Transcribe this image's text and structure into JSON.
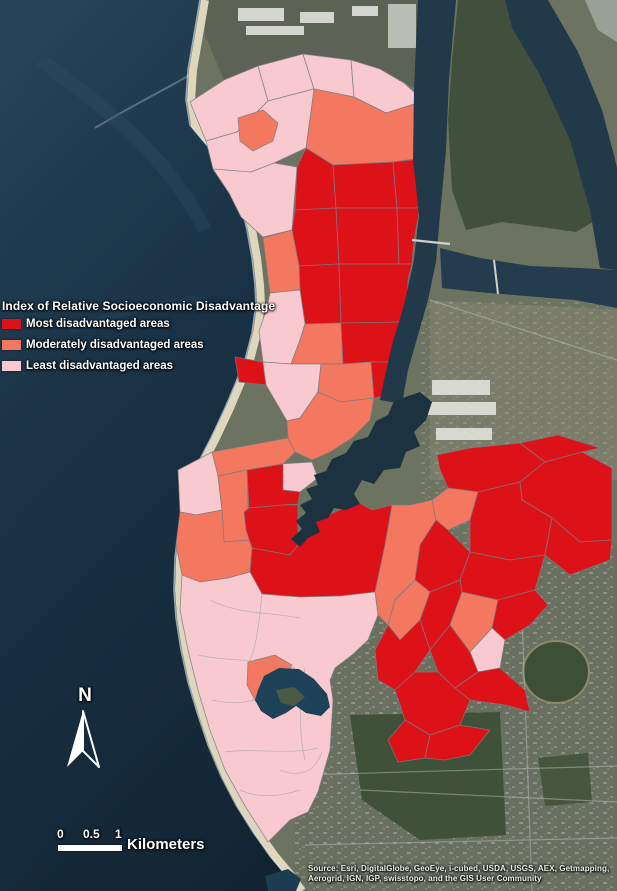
{
  "map": {
    "legend": {
      "title": "Index of Relative Socioeconomic Disadvantage",
      "items": [
        {
          "key": "most",
          "label": "Most disadvantaged areas"
        },
        {
          "key": "moderate",
          "label": "Moderately disadvantaged areas"
        },
        {
          "key": "least",
          "label": "Least disadvantaged areas"
        }
      ]
    },
    "class_colors": {
      "most": "#dc1218",
      "moderate": "#f4775f",
      "least": "#f9c9d0"
    },
    "region_stroke": "#787d83",
    "north_arrow": {
      "label": "N"
    },
    "scale_bar": {
      "tick_labels": [
        "0",
        "0.5",
        "1"
      ],
      "unit_label": "Kilometers"
    },
    "attribution": {
      "line1": "Source: Esri, DigitalGlobe, GeoEye, i-cubed, USDA, USGS, AEX, Getmapping,",
      "line2": "Aerogrid, IGN, IGP, swisstopo, and the GIS User Community"
    },
    "regions": [
      {
        "class": "least",
        "points": "190,102 224,80 258,66 268,101 237,132 206,141"
      },
      {
        "class": "least",
        "points": "258,66 303,54 314,89 268,101"
      },
      {
        "class": "least",
        "points": "303,54 351,60 354,97 314,89"
      },
      {
        "class": "least",
        "points": "351,60 380,69 404,83 424,101 386,113 354,97"
      },
      {
        "class": "moderate",
        "points": "314,89 354,97 386,113 424,101 434,156 393,162 333,165 306,148"
      },
      {
        "class": "least",
        "points": "206,141 237,132 268,101 314,89 306,148 274,163 251,172 229,193 213,169"
      },
      {
        "class": "moderate",
        "points": "238,118 263,110 278,123 273,141 253,151 240,141"
      },
      {
        "class": "least",
        "points": "213,169 229,193 241,217 263,237 292,230 297,167 274,163 251,172"
      },
      {
        "class": "most",
        "points": "306,148 333,165 336,208 295,210 297,167"
      },
      {
        "class": "most",
        "points": "333,165 393,162 397,208 336,208"
      },
      {
        "class": "most",
        "points": "393,162 430,158 433,185 420,208 397,208"
      },
      {
        "class": "most",
        "points": "295,210 336,208 339,264 299,266 292,230"
      },
      {
        "class": "most",
        "points": "336,208 397,208 399,264 339,264"
      },
      {
        "class": "most",
        "points": "397,208 420,208 414,240 412,264 399,264"
      },
      {
        "class": "most",
        "points": "299,266 339,264 341,323 305,324 300,290"
      },
      {
        "class": "most",
        "points": "339,264 399,264 412,264 408,280 406,322 341,323"
      },
      {
        "class": "moderate",
        "points": "263,238 292,230 299,266 300,290 270,293"
      },
      {
        "class": "least",
        "points": "270,293 300,290 305,324 300,340 291,364 263,362 259,331 266,311"
      },
      {
        "class": "moderate",
        "points": "305,324 341,323 343,364 321,364 291,364 300,340"
      },
      {
        "class": "most",
        "points": "341,323 406,322 401,345 396,362 371,362 343,364"
      },
      {
        "class": "most",
        "points": "235,357 263,362 266,385 239,382"
      },
      {
        "class": "least",
        "points": "263,362 291,364 321,364 318,392 300,418 287,421 266,385"
      },
      {
        "class": "moderate",
        "points": "321,364 343,364 371,362 374,398 341,402 318,392"
      },
      {
        "class": "most",
        "points": "371,362 396,362 392,382 386,396 374,398"
      },
      {
        "class": "moderate",
        "points": "287,421 300,418 318,392 341,402 374,398 370,420 352,438 330,452 312,460 295,452 288,438"
      },
      {
        "class": "moderate",
        "points": "212,452 288,438 295,452 283,464 247,470 218,476"
      },
      {
        "class": "least",
        "points": "280,464 312,462 318,478 300,492 283,490"
      },
      {
        "class": "least",
        "points": "178,470 212,452 218,476 222,510 196,515 180,512"
      },
      {
        "class": "moderate",
        "points": "218,476 247,470 249,540 224,542 222,510"
      },
      {
        "class": "most",
        "points": "247,470 283,464 283,490 300,492 298,504 283,505 249,508"
      },
      {
        "class": "most",
        "points": "244,512 249,508 283,505 298,505 298,545 290,555 252,548 246,530"
      },
      {
        "class": "moderate",
        "points": "180,512 196,515 222,510 224,542 249,540 252,548 250,572 228,578 200,582 182,575 176,545"
      },
      {
        "class": "most",
        "points": "252,548 290,555 298,545 306,536 318,530 314,520 326,516 344,508 358,502 372,510 392,505 385,545 375,592 340,596 300,597 262,594 250,572"
      },
      {
        "class": "moderate",
        "points": "385,545 392,505 410,505 432,500 436,520 420,545 415,580 395,600 388,625 378,615 375,592"
      },
      {
        "class": "most",
        "points": "437,455 470,448 520,443 545,462 520,482 478,492 448,488 440,470"
      },
      {
        "class": "most",
        "points": "545,462 582,452 612,468 612,540 580,542 552,518 522,500 520,482"
      },
      {
        "class": "most",
        "points": "520,443 558,435 600,448 582,452 545,462"
      },
      {
        "class": "moderate",
        "points": "448,488 478,492 470,520 448,530 436,520 432,500"
      },
      {
        "class": "most",
        "points": "478,492 520,482 522,500 552,518 545,555 510,560 470,552 470,520"
      },
      {
        "class": "most",
        "points": "552,518 580,542 612,540 610,560 570,575 545,555"
      },
      {
        "class": "most",
        "points": "436,520 448,530 470,552 460,580 430,592 415,580 420,545"
      },
      {
        "class": "most",
        "points": "470,552 510,560 545,555 535,590 498,600 462,592 460,580"
      },
      {
        "class": "moderate",
        "points": "415,580 430,592 420,620 400,640 388,625 395,600"
      },
      {
        "class": "most",
        "points": "430,592 460,580 462,592 450,625 430,650 420,620"
      },
      {
        "class": "moderate",
        "points": "462,592 498,600 492,628 470,652 450,625"
      },
      {
        "class": "most",
        "points": "498,600 535,590 548,605 530,625 505,640 492,628"
      },
      {
        "class": "least",
        "points": "470,652 492,628 505,640 500,668 478,672"
      },
      {
        "class": "most",
        "points": "388,625 400,640 420,620 430,650 415,672 395,690 378,680 375,650"
      },
      {
        "class": "most",
        "points": "430,650 450,625 470,652 478,672 455,688 438,672"
      },
      {
        "class": "most",
        "points": "455,688 478,672 500,668 525,690 530,712 505,705 470,700"
      },
      {
        "class": "most",
        "points": "395,690 415,672 438,672 455,688 470,700 460,725 430,735 405,720"
      },
      {
        "class": "most",
        "points": "405,720 430,735 425,758 398,762 388,740"
      },
      {
        "class": "most",
        "points": "430,735 460,725 490,730 470,755 445,760 425,758"
      },
      {
        "class": "least",
        "points": "182,575 200,582 228,578 250,572 262,594 300,597 340,596 375,592 378,615 368,640 352,655 335,668 330,680 333,700 330,750 318,792 308,812 290,820 268,842 245,806 225,770 210,730 198,690 188,650 180,610"
      },
      {
        "class": "moderate",
        "points": "248,662 275,655 292,665 285,678 278,690 280,700 270,708 256,702 247,685"
      }
    ]
  }
}
